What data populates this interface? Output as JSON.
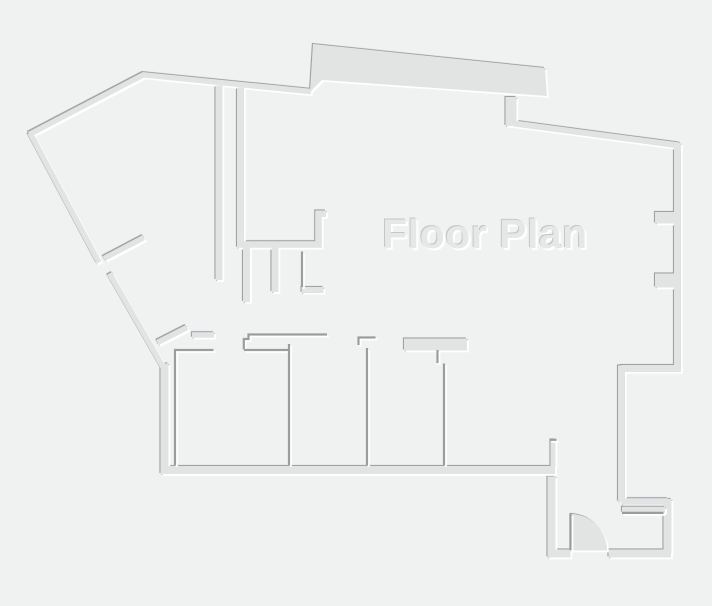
{
  "title": "Floor Plan",
  "canvas": {
    "width": 712,
    "height": 606,
    "background": "#f0f1f1"
  },
  "colors": {
    "wall_fill": "#e2e4e4",
    "line_dark": "#9a9d9e",
    "shadow_dark": "#96999b",
    "highlight": "#ffffff",
    "label_text": "#e6e8e8"
  },
  "label": {
    "text": "Floor Plan",
    "x": 485,
    "y": 237,
    "font_size": 41
  },
  "floorplan": {
    "outer_walls": [
      {
        "name": "wall-top-left-diagonal",
        "d": "M29.3,134.4 L144.5,74.3",
        "w": 5.5
      },
      {
        "name": "wall-top",
        "d": "M143,74.8 L311,91.6",
        "w": 5.5
      },
      {
        "name": "wall-left-diagonal-upper",
        "d": "M30,132.8 L99,262.5",
        "w": 5.5
      },
      {
        "name": "wall-left-diagonal-lower",
        "d": "M109.5,273.5 L163,367",
        "w": 5.5
      },
      {
        "name": "entry-partition-upper",
        "d": "M104,258.5 L144,237.5",
        "w": 5.5
      },
      {
        "name": "entry-partition-lower",
        "d": "M157.5,342.5 L187,327.5",
        "w": 5.5
      },
      {
        "name": "entry-wall-stub",
        "d": "M192,335 L214,335",
        "w": 5.5
      },
      {
        "name": "wall-protrusion-south",
        "d": "M511,97 L511,126",
        "w": 11
      },
      {
        "name": "wall-top-right",
        "d": "M514,123.5 L679,145.5",
        "w": 6
      },
      {
        "name": "wall-right",
        "d": "M677.5,143 L677.5,368.8",
        "w": 7
      },
      {
        "name": "wall-step-west",
        "d": "M681,368.5 L621,368.5",
        "w": 7
      },
      {
        "name": "wall-step-down",
        "d": "M621.5,365.5 L621.5,501.8",
        "w": 7
      },
      {
        "name": "wall-step-east",
        "d": "M621.5,501.5 L668,501.5",
        "w": 6.5
      },
      {
        "name": "wall-doorroom-right",
        "d": "M667.5,499 L667.5,553.5",
        "w": 8
      },
      {
        "name": "wall-doorroom-bottom",
        "d": "M671,553.5 L608.5,553.5",
        "w": 8
      },
      {
        "name": "wall-doorroom-left",
        "d": "M570.5,553.5 L551.5,553.5 L551.5,476.5",
        "w": 8
      },
      {
        "name": "wall-nook",
        "d": "M553,466.5 L553,439.5",
        "w": 5
      },
      {
        "name": "wall-outer-left",
        "d": "M164.5,363.5 L164.5,474",
        "w": 8
      },
      {
        "name": "wall-bottom",
        "d": "M161,470 L555,470",
        "w": 8
      },
      {
        "name": "wall-hall-west",
        "d": "M219,85.5 L219,280",
        "w": 7
      },
      {
        "name": "wall-hall-east",
        "d": "M240.5,87.5 L240.5,242",
        "w": 7
      },
      {
        "name": "wall-kitchen",
        "d": "M326,213.8 L318.5,213.8 L318.5,244.5 L237,244.5",
        "w": 6.5
      },
      {
        "name": "wall-bath-1",
        "d": "M246.5,246 L246.5,302",
        "w": 7
      },
      {
        "name": "wall-bath-2",
        "d": "M275,246 L275,292",
        "w": 7
      },
      {
        "name": "wall-bath-stub",
        "d": "M301.5,290 L323.5,290",
        "w": 6
      },
      {
        "name": "closet-block",
        "d": "M404,344.5 L467,344.5",
        "w": 12
      }
    ],
    "solids": [
      {
        "name": "protrusion-slab",
        "d": "M313,44 L545,68 L547,96 L322,80 L310,92 Z"
      },
      {
        "name": "window-stub-upper",
        "d": "M655,212 h20 v11.5 h-20 Z"
      },
      {
        "name": "window-stub-lower",
        "d": "M655,273.5 h20 v14 h-20 Z"
      }
    ],
    "overlay_bands": [
      {
        "name": "wall-doorroom-top",
        "d": "M622,509.8 L665,509.8",
        "w": 6,
        "type": "stroke"
      },
      {
        "name": "door-swing",
        "d": "M570.5,550.5 L570.5,514 A36.5,36.5 0 0 1 607,550.5 Z",
        "type": "fill"
      }
    ],
    "thin_walls": [
      {
        "name": "room1-left-top",
        "d": "M175,465 L175,350 L213.5,350"
      },
      {
        "name": "room1-top-right",
        "d": "M244,350 L289,350"
      },
      {
        "name": "corridor-wall-step",
        "d": "M243.8,349.5 L243.8,339 L248.5,339 L248.5,334.5 L327,334.5"
      },
      {
        "name": "room-divider-1",
        "d": "M289,344 L289,465"
      },
      {
        "name": "corridor-jamb",
        "d": "M358.5,345 L358.5,337.5 L375.5,337.5"
      },
      {
        "name": "room-divider-2",
        "d": "M367,348 L367,465"
      },
      {
        "name": "closet-stem",
        "d": "M437.5,350 L437.5,363"
      },
      {
        "name": "room-divider-3",
        "d": "M444,363.5 L444,465"
      },
      {
        "name": "nook-hook",
        "d": "M549.5,439.8 L556.5,439.8"
      },
      {
        "name": "doorroom-top-inner",
        "d": "M622,512.9 L663.5,512.9"
      },
      {
        "name": "bath-partition",
        "d": "M302,251.5 L302,287"
      },
      {
        "name": "door-leaf",
        "d": "M570.5,514 L570.5,550"
      }
    ]
  }
}
